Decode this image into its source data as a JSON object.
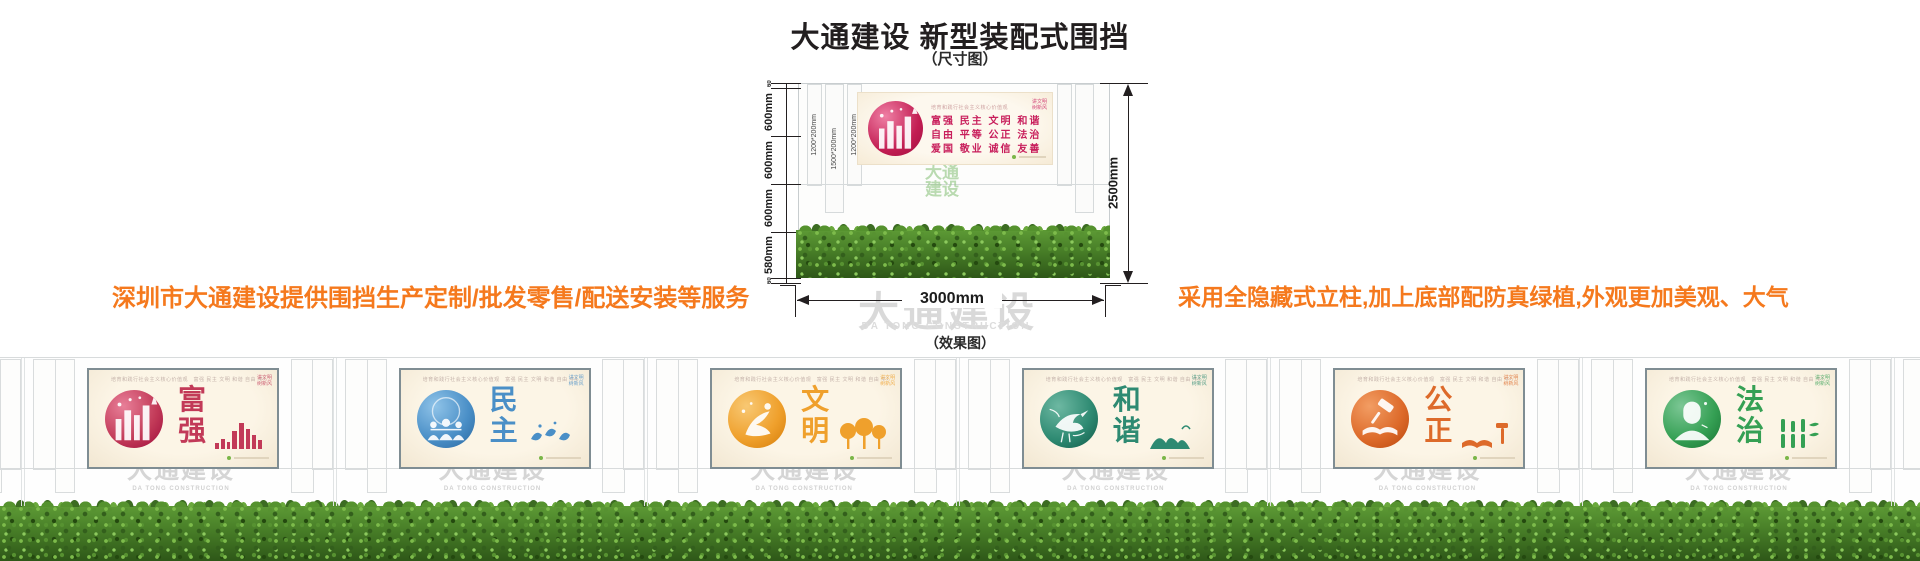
{
  "header": {
    "title": "大通建设 新型装配式围挡",
    "subtitle": "（尺寸图）",
    "effect_label": "（效果图）"
  },
  "notes": {
    "left": "深圳市大通建设提供围挡生产定制/批发零售/配送安装等服务",
    "right": "采用全隐藏式立柱,加上底部配防真绿植,外观更加美观、大气"
  },
  "watermark": {
    "cn": "大通建设",
    "en": "DA TONG CONSTRUCTION"
  },
  "dimensions": {
    "total_height": "2500mm",
    "total_width": "3000mm",
    "top_rail": "60",
    "bottom_rail": "60",
    "panel_segments": [
      "600mm",
      "600mm",
      "600mm"
    ],
    "hedge_height": "580mm",
    "posts": [
      "1200*200mm",
      "1500*200mm",
      "1200*200mm"
    ]
  },
  "sign": {
    "header": "培育和践行社会主义核心价值观",
    "rows": [
      "富强 民主 文明 和谐",
      "自由 平等 公正 法治",
      "爱国 敬业 诚信 友善"
    ],
    "corner": [
      "讲文明",
      "树新风"
    ]
  },
  "panel_strip": {
    "header": "培育和践行社会主义核心价值观　富强 民主 文明 和谐 自由 平等 公正 法治 爱国 敬业 诚信 友善",
    "corner": [
      "讲文明",
      "树新风"
    ]
  },
  "panels": [
    {
      "word": "富强",
      "color": "#c23a58",
      "light": "#e87f98",
      "dark": "#a3123f",
      "art": "city"
    },
    {
      "word": "民主",
      "color": "#4a8fc7",
      "light": "#8fc3e8",
      "dark": "#2f6ea6",
      "art": "people"
    },
    {
      "word": "文明",
      "color": "#efa02c",
      "light": "#f8c873",
      "dark": "#d9820f",
      "art": "dancer"
    },
    {
      "word": "和谐",
      "color": "#2e8a72",
      "light": "#6db8a2",
      "dark": "#16614f",
      "art": "crane"
    },
    {
      "word": "公正",
      "color": "#dd6a2a",
      "light": "#f29d63",
      "dark": "#bf4d12",
      "art": "gavel"
    },
    {
      "word": "法治",
      "color": "#35a054",
      "light": "#7cc795",
      "dark": "#1d7a38",
      "art": "judge"
    }
  ],
  "colors": {
    "accent_orange": "#f5791d",
    "dimension_line": "#231f20",
    "watermark_gray": "#d9d9d9",
    "panel_bg": "#fbf3e3",
    "hedge_green": "#477d27"
  }
}
